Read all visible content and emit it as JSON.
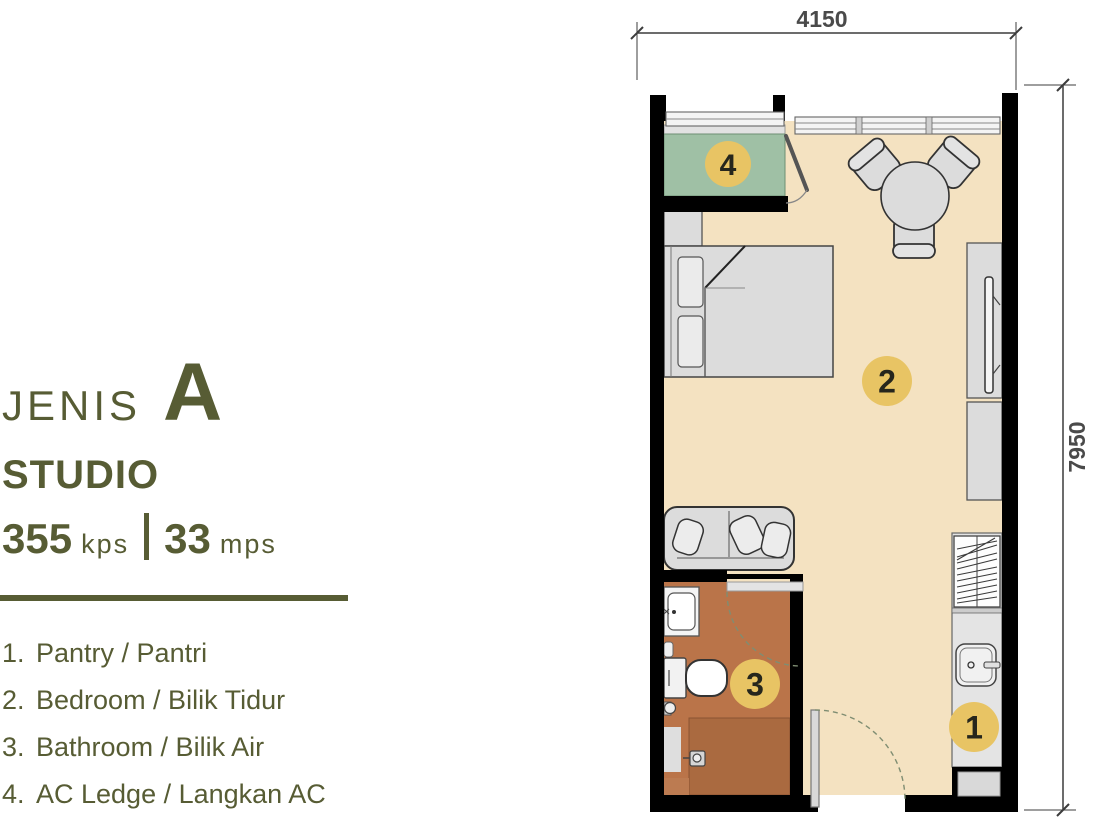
{
  "panel": {
    "series_label": "JENIS",
    "series_value": "A",
    "type_label": "STUDIO",
    "area": {
      "value1": "355",
      "unit1": "kps",
      "separator": "|",
      "value2": "33",
      "unit2": "mps"
    },
    "legend": [
      {
        "num": "1.",
        "label": "Pantry / Pantri"
      },
      {
        "num": "2.",
        "label": "Bedroom / Bilik Tidur"
      },
      {
        "num": "3.",
        "label": "Bathroom / Bilik Air"
      },
      {
        "num": "4.",
        "label": "AC Ledge / Langkan AC"
      }
    ]
  },
  "plan": {
    "dim_width": "4150",
    "dim_height": "7950",
    "markers": [
      {
        "num": "1",
        "room": "pantry"
      },
      {
        "num": "2",
        "room": "bedroom"
      },
      {
        "num": "3",
        "room": "bathroom"
      },
      {
        "num": "4",
        "room": "ac-ledge"
      }
    ]
  },
  "colors": {
    "accent_olive": "#575C34",
    "floor_beige": "#F4E2C1",
    "ac_ledge_green": "#9FC0A5",
    "bathroom_brown": "#BA7449",
    "shower_brown": "#AA6A40",
    "marker_gold": "#E8C464",
    "marker_number": "#26261C",
    "wall_black": "#000000",
    "dimension_gray": "#4A4A4A",
    "furniture_gray": "#DCDCDC"
  }
}
